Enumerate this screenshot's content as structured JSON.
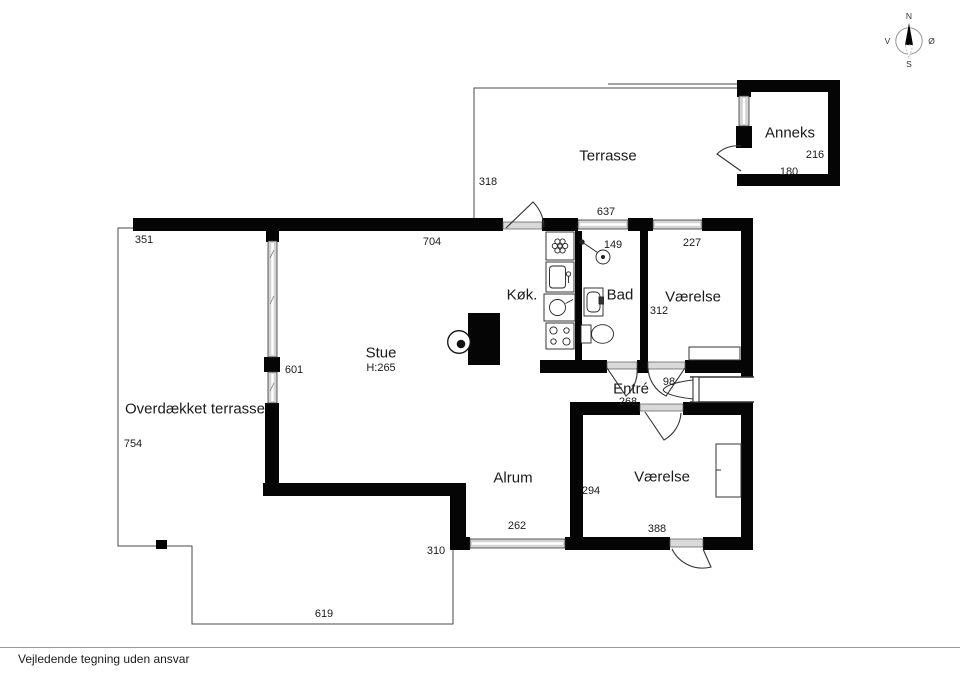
{
  "compass": {
    "north": "N",
    "east": "Ø",
    "south": "S",
    "west": "V"
  },
  "rooms": {
    "terrasse": "Terrasse",
    "anneks": "Anneks",
    "koekken": "Køk.",
    "bad": "Bad",
    "vaerelse_top": "Værelse",
    "stue": "Stue",
    "stue_ceiling_height": "H:265",
    "entre": "Entré",
    "overdaekket_terrasse": "Overdækket terrasse",
    "alrum": "Alrum",
    "vaerelse_bottom": "Værelse"
  },
  "dimensions": {
    "terrasse_depth": "318",
    "terrasse_width": "637",
    "anneks_depth": "216",
    "anneks_width": "180",
    "west_wing_top": "351",
    "stue_width": "704",
    "bad_width": "149",
    "vaerelse_top_width": "227",
    "vaerelse_top_depth": "312",
    "stue_window": "601",
    "entre_width": "268",
    "entre_door": "98",
    "overdaekket_depth": "754",
    "vaerelse_bottom_depth": "294",
    "alrum_window": "262",
    "vaerelse_bottom_width": "388",
    "deck_depth": "310",
    "deck_width": "619"
  },
  "footer": {
    "disclaimer": "Vejledende tegning uden ansvar"
  }
}
